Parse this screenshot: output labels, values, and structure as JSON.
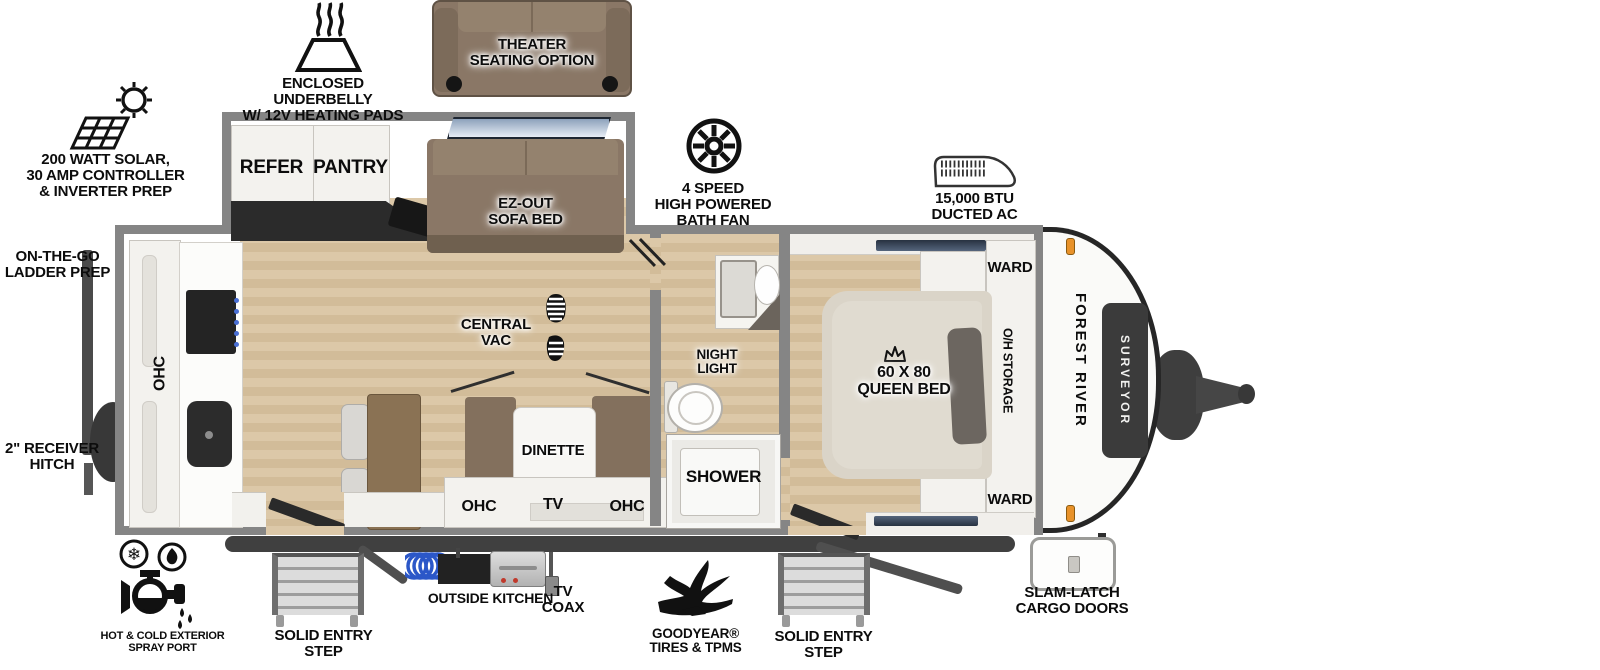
{
  "plan": {
    "brand_vertical": "FOREST RIVER",
    "model_badge": "SURVEYOR"
  },
  "callouts": {
    "underbelly": "ENCLOSED UNDERBELLY\nW/ 12V HEATING PADS",
    "solar": "200 WATT SOLAR,\n30 AMP CONTROLLER\n& INVERTER PREP",
    "theater": "THEATER\nSEATING OPTION",
    "bath_fan": "4 SPEED\nHIGH POWERED\nBATH FAN",
    "ducted_ac": "15,000 BTU\nDUCTED AC",
    "ladder": "ON-THE-GO\nLADDER PREP",
    "receiver_hitch": "2\" RECEIVER\nHITCH",
    "spray_port": "HOT & COLD EXTERIOR\nSPRAY PORT",
    "step_left": "SOLID ENTRY\nSTEP",
    "outside_kitchen": "OUTSIDE KITCHEN",
    "tv_coax": "TV\nCOAX",
    "tires": "GOODYEAR®\nTIRES & TPMS",
    "step_right": "SOLID ENTRY\nSTEP",
    "cargo": "SLAM-LATCH\nCARGO DOORS"
  },
  "rooms": {
    "refer": "REFER",
    "pantry": "PANTRY",
    "sofa": "EZ-OUT\nSOFA BED",
    "central_vac": "CENTRAL\nVAC",
    "dinette": "DINETTE",
    "ohc_left": "OHC",
    "tv": "TV",
    "ohc_right": "OHC",
    "ohc_rear": "OHC",
    "night_light": "NIGHT\nLIGHT",
    "shower": "SHOWER",
    "ward_top": "WARD",
    "ward_bottom": "WARD",
    "queen_bed": "60 X 80\nQUEEN BED",
    "oh_storage": "O/H STORAGE"
  },
  "colors": {
    "wall_gray": "#858585",
    "floor_tan": "#d8c3a2",
    "sofa_brown": "#8a7766",
    "bed_beige": "#dad4c8",
    "badge_dark": "#3b3b3b",
    "marker_orange": "#e8922a",
    "window_blue": "#8ca1bb",
    "coil_blue": "#2b57c8",
    "appliance_black": "#2b2b2b"
  },
  "icons": {
    "underbelly": "heating-pad-icon",
    "solar": "solar-panel-icon",
    "bath_fan": "fan-icon",
    "ducted_ac": "ac-unit-icon",
    "central_vac": "boot-print-icon",
    "queen_bed": "crown-icon",
    "spray_port": "faucet-hot-cold-icon",
    "steps": "entry-step-icon",
    "outside_kitchen": "griddle-and-hose-icon",
    "tv_coax": "coax-connector-icon",
    "tires": "goodyear-wingfoot-icon"
  }
}
